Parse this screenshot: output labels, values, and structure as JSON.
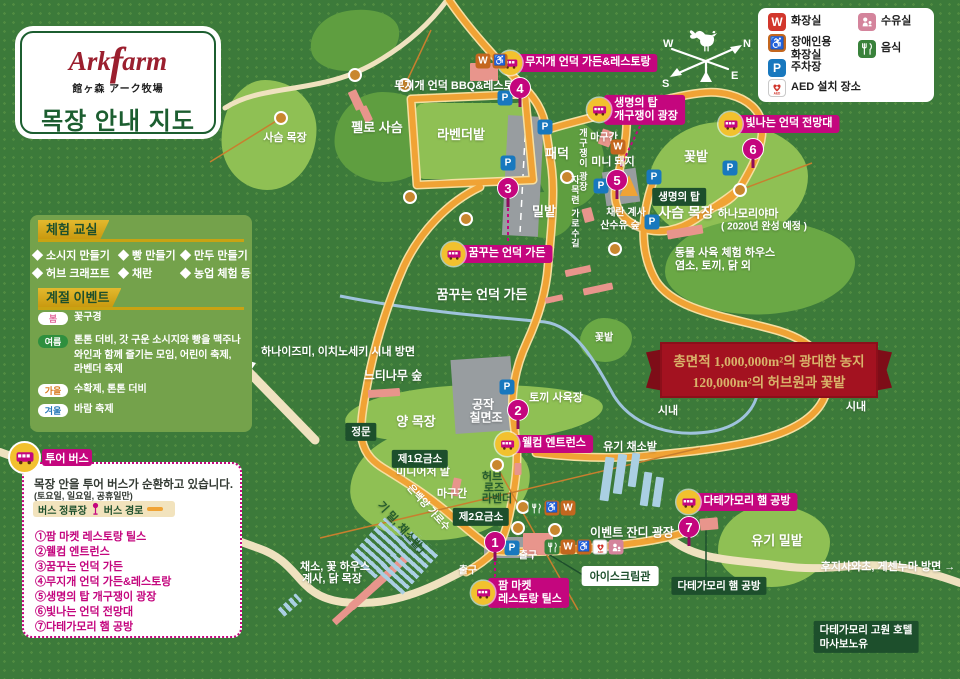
{
  "logo": {
    "brand_a": "Ark",
    "brand_f": "f",
    "brand_b": "arm",
    "jp": "館ヶ森 アーク牧場",
    "title": "목장 안내 지도"
  },
  "compass": {
    "n": "N",
    "e": "E",
    "s": "S",
    "w": "W"
  },
  "legend": {
    "items": [
      {
        "t": "wred",
        "label": "화장실",
        "x": 768,
        "y": 13,
        "tl": true
      },
      {
        "t": "wc",
        "label": "장애인용\n화장실",
        "x": 768,
        "y": 34,
        "tl": true
      },
      {
        "t": "p",
        "label": "주차장",
        "x": 768,
        "y": 59,
        "tl": true
      },
      {
        "t": "aed",
        "label": "AED 설치 장소",
        "x": 768,
        "y": 79,
        "tl": true
      },
      {
        "t": "nurse",
        "label": "수유실",
        "x": 858,
        "y": 13,
        "tl": true
      },
      {
        "t": "food",
        "label": "음식",
        "x": 858,
        "y": 40,
        "tl": true
      }
    ]
  },
  "experience": {
    "title": "체험 교실",
    "items": [
      {
        "text": "◆ 소시지 만들기",
        "x": 32,
        "y": 247,
        "tl": true
      },
      {
        "text": "◆ 빵 만들기",
        "x": 118,
        "y": 247,
        "tl": true
      },
      {
        "text": "◆ 만두 만들기",
        "x": 180,
        "y": 247,
        "tl": true
      },
      {
        "text": "◆ 허브 크래프트",
        "x": 32,
        "y": 265,
        "tl": true
      },
      {
        "text": "◆ 채란",
        "x": 118,
        "y": 265,
        "tl": true
      },
      {
        "text": "◆ 농업 체험 등",
        "x": 180,
        "y": 265,
        "tl": true
      }
    ]
  },
  "seasonal": {
    "title": "계절 이벤트",
    "rows": [
      {
        "season": "봄",
        "scls": "spring",
        "x": 38,
        "y": 311,
        "tl": true,
        "lines": [
          "꽃구경"
        ]
      },
      {
        "season": "여름",
        "scls": "summer",
        "x": 38,
        "y": 334,
        "tl": true,
        "lines": [
          "톤톤 더비, 갓 구운 소시지와 빵을 맥주나",
          "와인과 함께 즐기는 모임, 어린이 축제,",
          "라벤더 축제"
        ]
      },
      {
        "season": "가을",
        "scls": "fall",
        "x": 38,
        "y": 383,
        "tl": true,
        "lines": [
          "수확제, 톤톤 더비"
        ]
      },
      {
        "season": "겨울",
        "scls": "winter",
        "x": 38,
        "y": 403,
        "tl": true,
        "lines": [
          "바람 축제"
        ]
      }
    ]
  },
  "tour": {
    "title": "투어 버스",
    "line1": "목장 안을 투어 버스가 순환하고 있습니다.",
    "line2": "(토요일, 일요일, 공휴일만)",
    "stop_label": "버스 정류장",
    "route_label": "버스 경로",
    "stops": [
      {
        "text": "①팜 마켓 레스토랑 틸스",
        "x": 35,
        "y": 528,
        "tl": true
      },
      {
        "text": "②웰컴 엔트런스",
        "x": 35,
        "y": 543,
        "tl": true
      },
      {
        "text": "③꿈꾸는 언덕 가든",
        "x": 35,
        "y": 558,
        "tl": true
      },
      {
        "text": "④무지개 언덕 가든&레스토랑",
        "x": 35,
        "y": 573,
        "tl": true
      },
      {
        "text": "⑤생명의 탑 개구쟁이 광장",
        "x": 35,
        "y": 588,
        "tl": true
      },
      {
        "text": "⑥빛나는 언덕 전망대",
        "x": 35,
        "y": 603,
        "tl": true
      },
      {
        "text": "⑦다테가모리 햄 공방",
        "x": 35,
        "y": 618,
        "tl": true
      }
    ]
  },
  "ribbon": {
    "line1": "총면적 1,000,000m²의 광대한 농지",
    "line2": "120,000m²의 허브원과 꽃밭"
  },
  "colors": {
    "magenta": "#c4067e",
    "road_orange": "#f0a335",
    "dark_green": "#1d4f2c",
    "ribbon_red": "#a31220",
    "background_green": "#3c7a3a"
  },
  "map": {
    "patches": [
      {
        "x": 269,
        "y": 135,
        "w": 95,
        "h": 110,
        "cls": "light"
      },
      {
        "x": 387,
        "y": 137,
        "w": 105,
        "h": 90,
        "cls": "mid"
      },
      {
        "x": 355,
        "y": 40,
        "w": 90,
        "h": 60,
        "cls": "mid",
        "rot": -10
      },
      {
        "x": 472,
        "y": 141,
        "w": 114,
        "h": 76,
        "cls": "light rect"
      },
      {
        "x": 571,
        "y": 164,
        "w": 66,
        "h": 88,
        "cls": "mid"
      },
      {
        "x": 728,
        "y": 182,
        "w": 160,
        "h": 120,
        "cls": "light"
      },
      {
        "x": 760,
        "y": 267,
        "w": 190,
        "h": 95,
        "cls": "mid2"
      },
      {
        "x": 546,
        "y": 215,
        "w": 56,
        "h": 46,
        "cls": "mid"
      },
      {
        "x": 606,
        "y": 340,
        "w": 52,
        "h": 44,
        "cls": "mid2"
      },
      {
        "x": 474,
        "y": 414,
        "w": 258,
        "h": 58,
        "cls": "light",
        "rot": -2
      },
      {
        "x": 440,
        "y": 484,
        "w": 180,
        "h": 112,
        "cls": "light",
        "rot": -2
      },
      {
        "x": 774,
        "y": 546,
        "w": 112,
        "h": 82,
        "cls": "light"
      }
    ],
    "buildings": [
      {
        "x": 484,
        "y": 72,
        "w": 28,
        "h": 18
      },
      {
        "x": 356,
        "y": 100,
        "w": 9,
        "h": 20,
        "rot": -25
      },
      {
        "x": 366,
        "y": 114,
        "w": 8,
        "h": 16,
        "rot": -25
      },
      {
        "x": 606,
        "y": 138,
        "w": 12,
        "h": 16,
        "rot": 20
      },
      {
        "x": 588,
        "y": 215,
        "w": 10,
        "h": 14,
        "rot": -15
      },
      {
        "x": 685,
        "y": 232,
        "w": 36,
        "h": 9,
        "rot": -10
      },
      {
        "x": 578,
        "y": 271,
        "w": 26,
        "h": 7,
        "rot": -12
      },
      {
        "x": 598,
        "y": 289,
        "w": 30,
        "h": 7,
        "rot": -12
      },
      {
        "x": 554,
        "y": 299,
        "w": 18,
        "h": 6,
        "rot": -12
      },
      {
        "x": 384,
        "y": 393,
        "w": 32,
        "h": 8,
        "rot": -4
      },
      {
        "x": 456,
        "y": 487,
        "w": 8,
        "h": 18,
        "rot": 12
      },
      {
        "x": 518,
        "y": 469,
        "w": 7,
        "h": 12
      },
      {
        "x": 538,
        "y": 544,
        "w": 30,
        "h": 22
      },
      {
        "x": 709,
        "y": 524,
        "w": 18,
        "h": 12,
        "rot": -5
      },
      {
        "x": 390,
        "y": 572,
        "w": 46,
        "h": 8,
        "rot": -42
      },
      {
        "x": 368,
        "y": 592,
        "w": 46,
        "h": 8,
        "rot": -42
      },
      {
        "x": 346,
        "y": 612,
        "w": 32,
        "h": 7,
        "rot": -42
      },
      {
        "x": 290,
        "y": 605,
        "w": 24,
        "h": 10,
        "rot": -42,
        "cls": "bstripe"
      },
      {
        "x": 380,
        "y": 548,
        "w": 52,
        "h": 34,
        "rot": -48,
        "cls": "bstripe"
      },
      {
        "x": 408,
        "y": 562,
        "w": 56,
        "h": 36,
        "rot": -48,
        "cls": "bstripe"
      },
      {
        "x": 607,
        "y": 479,
        "w": 9,
        "h": 44,
        "rot": 8,
        "cls": "bbar"
      },
      {
        "x": 620,
        "y": 474,
        "w": 9,
        "h": 40,
        "rot": 8,
        "cls": "bbar"
      },
      {
        "x": 634,
        "y": 470,
        "w": 8,
        "h": 34,
        "rot": 8,
        "cls": "bbar"
      },
      {
        "x": 646,
        "y": 489,
        "w": 8,
        "h": 34,
        "rot": 8,
        "cls": "bbar"
      },
      {
        "x": 658,
        "y": 492,
        "w": 8,
        "h": 30,
        "rot": 8,
        "cls": "bbar"
      }
    ],
    "trees": [
      {
        "x": 281,
        "y": 118
      },
      {
        "x": 355,
        "y": 75
      },
      {
        "x": 405,
        "y": 85
      },
      {
        "x": 410,
        "y": 197
      },
      {
        "x": 466,
        "y": 219
      },
      {
        "x": 567,
        "y": 177
      },
      {
        "x": 615,
        "y": 249
      },
      {
        "x": 740,
        "y": 190
      },
      {
        "x": 497,
        "y": 465
      },
      {
        "x": 523,
        "y": 507
      },
      {
        "x": 518,
        "y": 528
      },
      {
        "x": 555,
        "y": 530
      }
    ],
    "labels": [
      {
        "text": "무지개 언덕 BBQ&레스토랑",
        "x": 459,
        "y": 86,
        "size": 11
      },
      {
        "text": "사슴 목장",
        "x": 285,
        "y": 138,
        "size": 11
      },
      {
        "text": "펠로 사슴",
        "x": 377,
        "y": 128,
        "size": 13
      },
      {
        "text": "라벤더밭",
        "x": 461,
        "y": 135,
        "size": 13
      },
      {
        "text": "패덕",
        "x": 557,
        "y": 154,
        "size": 13
      },
      {
        "text": "마구간",
        "x": 604,
        "y": 138,
        "size": 10
      },
      {
        "text": "미니 돼지",
        "x": 613,
        "y": 162,
        "size": 11
      },
      {
        "text": "개구쟁이 광장",
        "x": 582,
        "y": 160,
        "size": 9,
        "vertical": true
      },
      {
        "text": "꽃밭",
        "x": 696,
        "y": 157,
        "size": 13
      },
      {
        "text": "밀밭",
        "x": 544,
        "y": 212,
        "size": 13
      },
      {
        "text": "자목련 가로수길",
        "x": 574,
        "y": 212,
        "size": 9,
        "vertical": true
      },
      {
        "text": "채란 계사",
        "x": 626,
        "y": 213,
        "size": 10
      },
      {
        "text": "산수유 숲",
        "x": 620,
        "y": 226,
        "size": 10
      },
      {
        "text": "사슴 목장",
        "x": 686,
        "y": 213,
        "size": 14
      },
      {
        "text": "하나모리야마",
        "x": 748,
        "y": 214,
        "size": 11
      },
      {
        "text": "( 2020년 완성 예정 )",
        "x": 764,
        "y": 227,
        "size": 10
      },
      {
        "text": "동물 사육 체험 하우스",
        "x": 725,
        "y": 253,
        "size": 11
      },
      {
        "text": "염소, 토끼, 닭 외",
        "x": 713,
        "y": 266,
        "size": 11
      },
      {
        "text": "꿈꾸는 언덕 가든",
        "x": 482,
        "y": 295,
        "size": 13
      },
      {
        "text": "하나이즈미, 이치노세키 시내 방면",
        "x": 338,
        "y": 352,
        "size": 11
      },
      {
        "text": "느티나무 숲",
        "x": 393,
        "y": 376,
        "size": 12
      },
      {
        "text": "꽃밭",
        "x": 604,
        "y": 338,
        "size": 10
      },
      {
        "text": "시내",
        "x": 668,
        "y": 411,
        "size": 11
      },
      {
        "text": "시내",
        "x": 856,
        "y": 407,
        "size": 11
      },
      {
        "text": "양 목장",
        "x": 416,
        "y": 422,
        "size": 13
      },
      {
        "text": "공작",
        "x": 483,
        "y": 405,
        "size": 12
      },
      {
        "text": "칠면조",
        "x": 486,
        "y": 418,
        "size": 12
      },
      {
        "text": "토끼 사육장",
        "x": 556,
        "y": 398,
        "size": 11
      },
      {
        "text": "유기 채소밭",
        "x": 630,
        "y": 447,
        "size": 11
      },
      {
        "text": "미니어처 말",
        "x": 423,
        "y": 472,
        "size": 11
      },
      {
        "text": "마구간",
        "x": 452,
        "y": 494,
        "size": 11
      },
      {
        "text": "허브",
        "x": 492,
        "y": 477,
        "size": 11,
        "color": "#245c2d"
      },
      {
        "text": "로즈",
        "x": 494,
        "y": 488,
        "size": 11,
        "color": "#245c2d"
      },
      {
        "text": "라벤더",
        "x": 497,
        "y": 499,
        "size": 11,
        "color": "#245c2d"
      },
      {
        "text": "은백양 가로수",
        "x": 428,
        "y": 508,
        "size": 10,
        "rot": 48
      },
      {
        "text": "기 밀, 채소밭」",
        "x": 403,
        "y": 530,
        "size": 11,
        "rot": 48,
        "color": "#245c2d"
      },
      {
        "text": "이벤트 잔디 광장",
        "x": 632,
        "y": 533,
        "size": 12
      },
      {
        "text": "출구",
        "x": 528,
        "y": 556,
        "size": 10
      },
      {
        "text": "출구",
        "x": 468,
        "y": 571,
        "size": 10
      },
      {
        "text": "채소, 꽃 하우스",
        "x": 335,
        "y": 567,
        "size": 11
      },
      {
        "text": "계사, 닭 목장",
        "x": 332,
        "y": 579,
        "size": 11
      },
      {
        "text": "유기 밀밭",
        "x": 777,
        "y": 541,
        "size": 13
      },
      {
        "text": "후지사와초, 게센누마 방면 →",
        "x": 888,
        "y": 567,
        "size": 11
      }
    ],
    "green_badges": [
      {
        "lines": [
          "생명의 탑"
        ],
        "x": 679,
        "y": 197
      },
      {
        "lines": [
          "정문"
        ],
        "x": 361,
        "y": 432
      },
      {
        "lines": [
          "제1요금소"
        ],
        "x": 420,
        "y": 459
      },
      {
        "lines": [
          "제2요금소"
        ],
        "x": 481,
        "y": 517
      },
      {
        "lines": [
          "다테가모리 햄 공방"
        ],
        "x": 719,
        "y": 586
      },
      {
        "lines": [
          "다테가모리 고원 호텔",
          "마사보노유"
        ],
        "x": 866,
        "y": 637
      }
    ],
    "white_badges": [
      {
        "lines": [
          "아이스크림관"
        ],
        "x": 620,
        "y": 576
      }
    ],
    "bus_badges": [
      {
        "lines": [
          "무지개 언덕 가든&레스토랑"
        ],
        "x": 578,
        "y": 63
      },
      {
        "lines": [
          "생명의 탑",
          "개구쟁이 광장"
        ],
        "x": 636,
        "y": 110
      },
      {
        "lines": [
          "빛나는 언덕 전망대"
        ],
        "x": 779,
        "y": 124
      },
      {
        "lines": [
          "꿈꾸는 언덕 가든"
        ],
        "x": 497,
        "y": 254
      },
      {
        "lines": [
          "웰컴 엔트런스"
        ],
        "x": 544,
        "y": 444
      },
      {
        "lines": [
          "팜 마켓",
          "레스토랑 틸스"
        ],
        "x": 520,
        "y": 593
      },
      {
        "lines": [
          "다테가모리 햄 공방"
        ],
        "x": 737,
        "y": 502
      }
    ],
    "stops": [
      {
        "n": "1",
        "x": 495,
        "y": 542
      },
      {
        "n": "2",
        "x": 518,
        "y": 410
      },
      {
        "n": "3",
        "x": 508,
        "y": 188
      },
      {
        "n": "4",
        "x": 520,
        "y": 88
      },
      {
        "n": "5",
        "x": 617,
        "y": 180
      },
      {
        "n": "6",
        "x": 753,
        "y": 149
      },
      {
        "n": "7",
        "x": 689,
        "y": 527
      }
    ],
    "icons": [
      {
        "t": "w",
        "x": 483,
        "y": 61
      },
      {
        "t": "wc",
        "x": 500,
        "y": 61
      },
      {
        "t": "w",
        "x": 618,
        "y": 147
      },
      {
        "t": "p",
        "x": 505,
        "y": 98
      },
      {
        "t": "p",
        "x": 545,
        "y": 127
      },
      {
        "t": "p",
        "x": 508,
        "y": 163
      },
      {
        "t": "p",
        "x": 601,
        "y": 186
      },
      {
        "t": "p",
        "x": 654,
        "y": 177
      },
      {
        "t": "p",
        "x": 730,
        "y": 168
      },
      {
        "t": "p",
        "x": 652,
        "y": 222
      },
      {
        "t": "p",
        "x": 507,
        "y": 387
      },
      {
        "t": "p",
        "x": 512,
        "y": 548
      },
      {
        "t": "food",
        "x": 536,
        "y": 508
      },
      {
        "t": "wc",
        "x": 552,
        "y": 508
      },
      {
        "t": "w",
        "x": 568,
        "y": 508
      },
      {
        "t": "food",
        "x": 552,
        "y": 547
      },
      {
        "t": "w",
        "x": 568,
        "y": 547
      },
      {
        "t": "wc",
        "x": 584,
        "y": 547
      },
      {
        "t": "aed",
        "x": 600,
        "y": 547
      },
      {
        "t": "nurse",
        "x": 616,
        "y": 547
      }
    ]
  }
}
